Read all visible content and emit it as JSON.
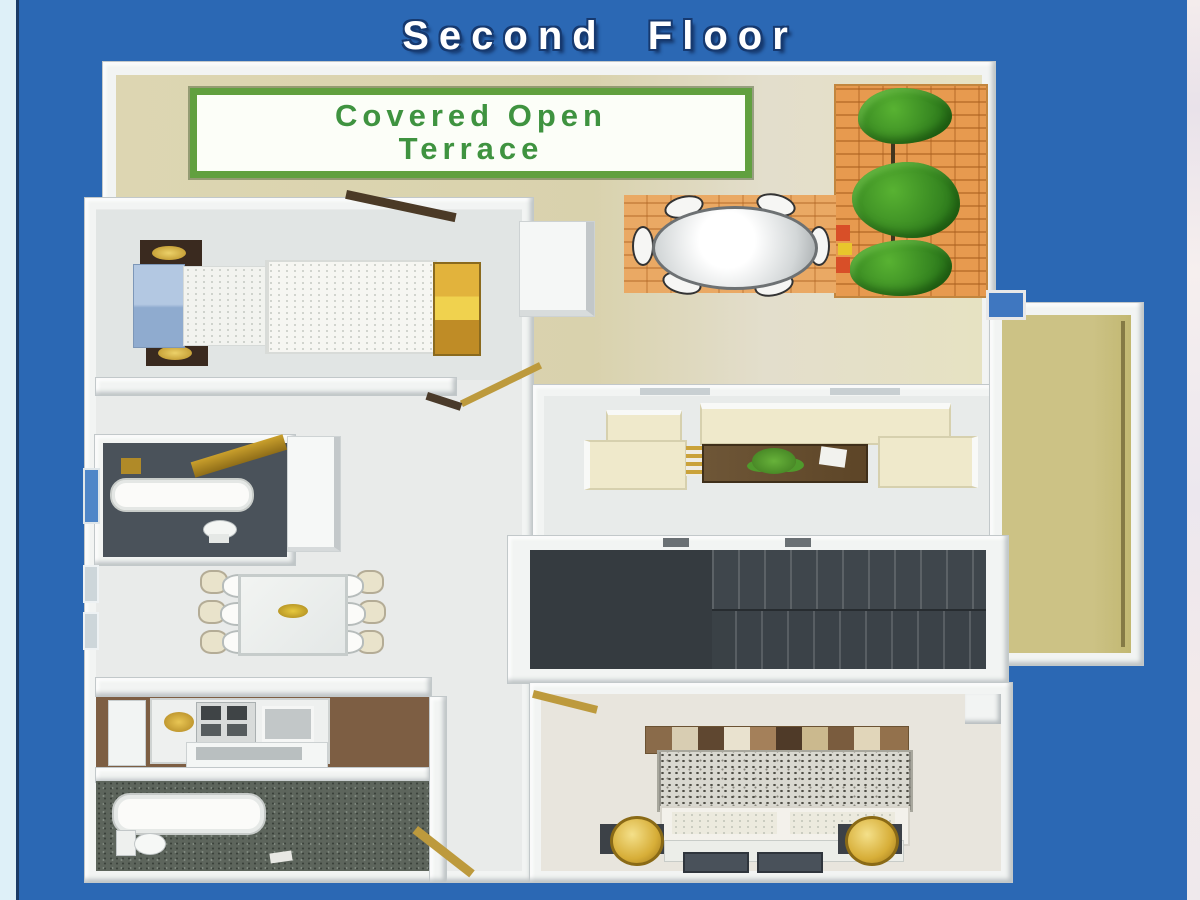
{
  "page": {
    "title": "Second Floor",
    "background_color": "#2b68b4",
    "title_color": "#ffffff",
    "title_outline_color": "#16396f"
  },
  "plan": {
    "sign": {
      "line1": "Covered Open",
      "line2": "Terrace",
      "text_color": "#3f9340",
      "border_color": "#61a03f",
      "background": "#fcfef8"
    },
    "areas": [
      {
        "id": "covered-open-terrace"
      },
      {
        "id": "planter-with-trees"
      },
      {
        "id": "outdoor-oval-table"
      },
      {
        "id": "bedroom-top-left"
      },
      {
        "id": "bathroom-top-left"
      },
      {
        "id": "dining-area"
      },
      {
        "id": "living-area"
      },
      {
        "id": "stairwell"
      },
      {
        "id": "kitchen"
      },
      {
        "id": "bathroom-bottom-left"
      },
      {
        "id": "bedroom-bottom-right"
      },
      {
        "id": "side-balcony"
      }
    ],
    "colors": {
      "terrace_floor": "#d9d2ad",
      "planter_orange": "#e79a4f",
      "tree_green": "#3c9326",
      "house_floor": "#e7eae9",
      "wall_white": "#f2f4f3",
      "stairs_dark": "#3a4146",
      "bathroom_floor": "#4a525a",
      "kitchen_floor": "#7d5e43",
      "sofa_cream": "#efe9cb",
      "bed_headboard_blue": "#a9c0dc",
      "gold_accent": "#d2a834",
      "balcony_olive": "#c7bd7d"
    }
  }
}
